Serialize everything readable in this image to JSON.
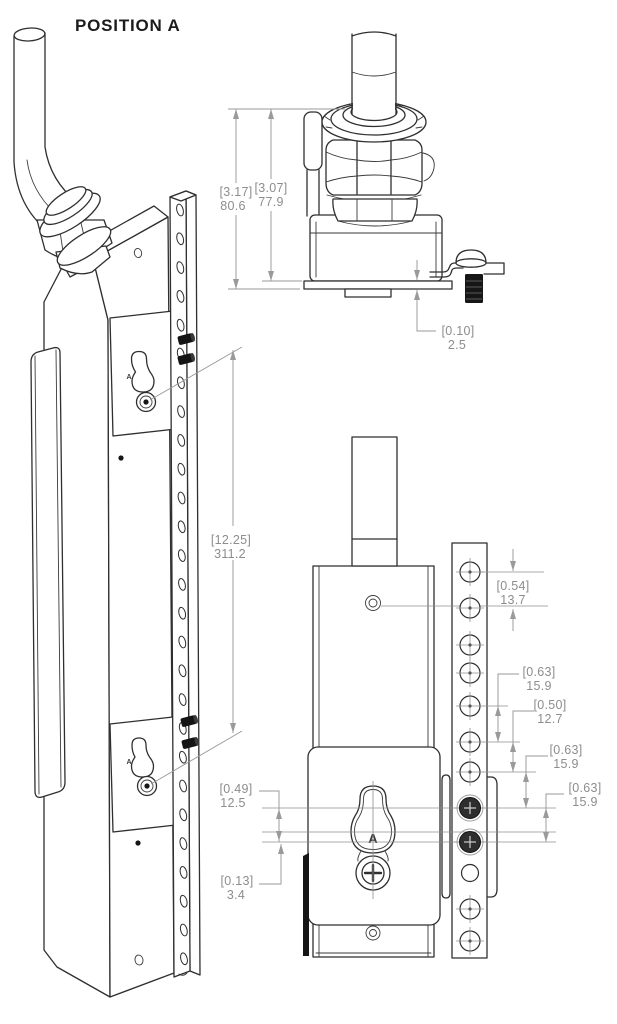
{
  "title": "POSITION A",
  "position_marker": "A",
  "colors": {
    "background": "#ffffff",
    "part_line": "#2f2f2f",
    "dim_line": "#9a9a9a",
    "dim_text": "#8d8d8d",
    "hardware_fill": "#161616"
  },
  "views": {
    "isometric": {
      "dims": {
        "keyhole_span": {
          "in": "[12.25]",
          "mm": "311.2"
        }
      }
    },
    "top": {
      "dims": {
        "overall_height": {
          "in": "[3.17]",
          "mm": "80.6"
        },
        "body_height": {
          "in": "[3.07]",
          "mm": "77.9"
        },
        "plate_thickness": {
          "in": "[0.10]",
          "mm": "2.5"
        }
      }
    },
    "front": {
      "dims": {
        "hole_pitch_top": {
          "in": "[0.54]",
          "mm": "13.7"
        },
        "hole_pitch_a": {
          "in": "[0.63]",
          "mm": "15.9"
        },
        "hole_pitch_b": {
          "in": "[0.50]",
          "mm": "12.7"
        },
        "hole_pitch_c": {
          "in": "[0.63]",
          "mm": "15.9"
        },
        "hole_pitch_d": {
          "in": "[0.63]",
          "mm": "15.9"
        },
        "keyhole_offset": {
          "in": "[0.49]",
          "mm": "12.5"
        },
        "center_offset": {
          "in": "[0.13]",
          "mm": "3.4"
        }
      }
    }
  }
}
